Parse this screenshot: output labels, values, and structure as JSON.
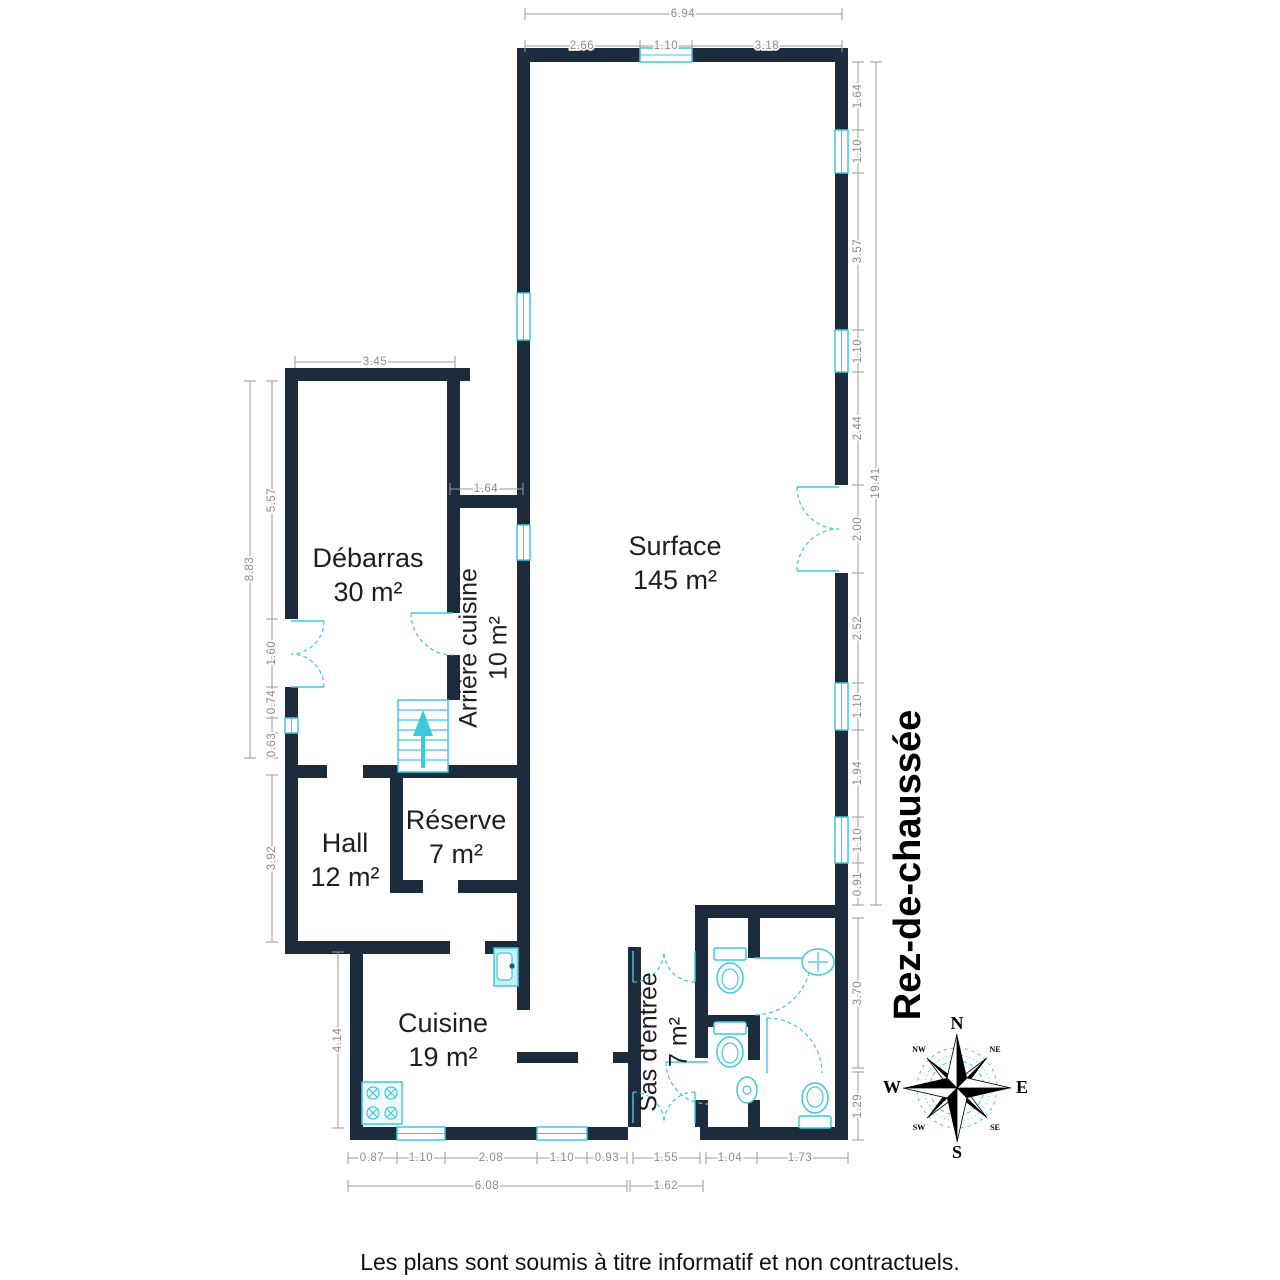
{
  "floor_title": "Rez-de-chaussée",
  "disclaimer": "Les plans sont soumis à titre informatif et non contractuels.",
  "rooms": [
    {
      "name": "Débarras",
      "area": "30 m²"
    },
    {
      "name": "Arrière cuisine",
      "area": "10 m²"
    },
    {
      "name": "Surface",
      "area": "145 m²"
    },
    {
      "name": "Hall",
      "area": "12 m²"
    },
    {
      "name": "Réserve",
      "area": "7 m²"
    },
    {
      "name": "Cuisine",
      "area": "19 m²"
    },
    {
      "name": "Sas d'entrée",
      "area": "7 m²"
    }
  ],
  "compass": {
    "n": "N",
    "e": "E",
    "s": "S",
    "w": "W",
    "ne": "NE",
    "nw": "NW",
    "se": "SE",
    "sw": "SW"
  },
  "dims": {
    "top_total": "6.94",
    "top": [
      "2.66",
      "1.10",
      "3.18"
    ],
    "right": [
      "1.64",
      "1.10",
      "3.57",
      "1.10",
      "2.44",
      "2.00",
      "2.52",
      "1.10",
      "1.94",
      "1.10",
      "0.91"
    ],
    "right_total": "19.41",
    "right_lower": [
      "3.70",
      "1.29"
    ],
    "left_total": "8.83",
    "left": [
      "5.57",
      "1.60",
      "0.74",
      "0.63"
    ],
    "hall_height": "3.92",
    "kitchen_height": "4.14",
    "debarras_width": "3.45",
    "opening_width": "1.64",
    "bottom": [
      "0.87",
      "1.10",
      "2.08",
      "1.10",
      "0.93"
    ],
    "bottom_total": "6.08",
    "entrance": [
      "1.55",
      "1.62"
    ],
    "wc_bottom": [
      "1.04",
      "1.73"
    ]
  },
  "colors": {
    "wall": "#1d2c3c",
    "fixture": "#3ec9dd",
    "dimension": "#8a8a8a"
  }
}
